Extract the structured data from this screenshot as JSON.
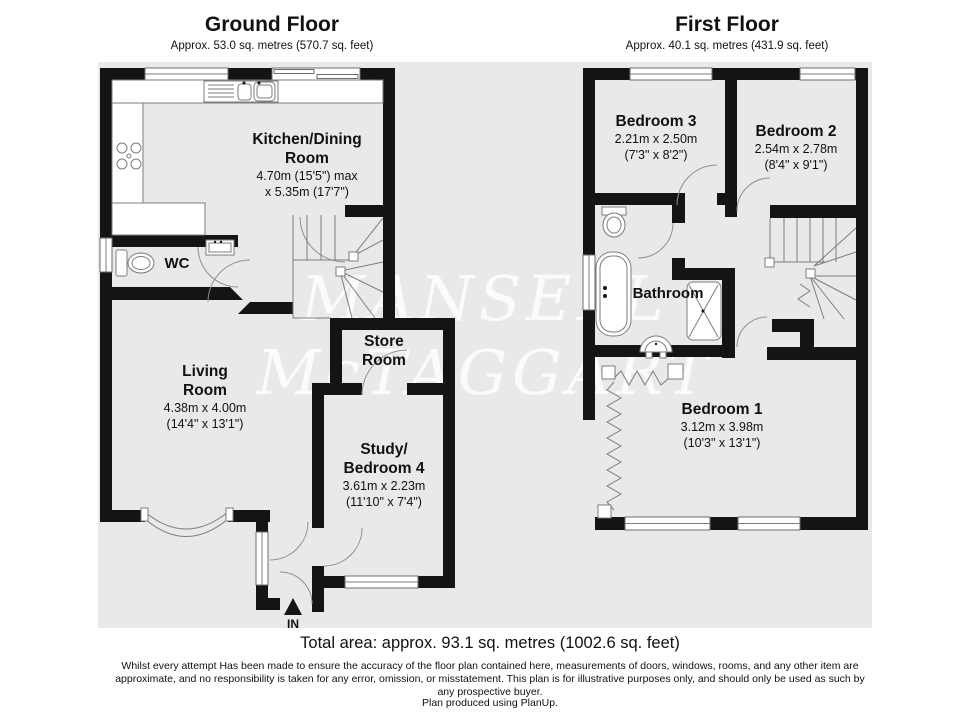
{
  "watermark": {
    "line1": "MANSELL",
    "line2": "McTAGGART"
  },
  "ground_floor": {
    "title": "Ground Floor",
    "area": "Approx. 53.0 sq. metres (570.7 sq. feet)",
    "rooms": {
      "kitchen": {
        "line1": "Kitchen/Dining",
        "line2": "Room",
        "dim1": "4.70m (15'5\") max",
        "dim2": "x 5.35m (17'7\")"
      },
      "wc": {
        "name": "WC"
      },
      "living": {
        "line1": "Living",
        "line2": "Room",
        "dim1": "4.38m x 4.00m",
        "dim2": "(14'4\" x 13'1\")"
      },
      "store": {
        "line1": "Store",
        "line2": "Room"
      },
      "study": {
        "line1": "Study/",
        "line2": "Bedroom 4",
        "dim1": "3.61m x 2.23m",
        "dim2": "(11'10\" x 7'4\")"
      }
    },
    "entrance_label": "IN"
  },
  "first_floor": {
    "title": "First Floor",
    "area": "Approx. 40.1 sq. metres (431.9 sq. feet)",
    "rooms": {
      "bedroom3": {
        "name": "Bedroom 3",
        "dim1": "2.21m x 2.50m",
        "dim2": "(7'3\" x 8'2\")"
      },
      "bedroom2": {
        "name": "Bedroom 2",
        "dim1": "2.54m x 2.78m",
        "dim2": "(8'4\" x 9'1\")"
      },
      "bathroom": {
        "name": "Bathroom"
      },
      "bedroom1": {
        "name": "Bedroom 1",
        "dim1": "3.12m x 3.98m",
        "dim2": "(10'3\" x 13'1\")"
      }
    }
  },
  "footer": {
    "total_area": "Total area: approx. 93.1 sq. metres (1002.6 sq. feet)",
    "disclaimer": "Whilst every attempt Has been made to ensure the accuracy of the floor plan contained here, measurements of doors, windows, rooms, and any other item are approximate, and no responsibility is taken for any error, omission, or misstatement. This plan is for illustrative purposes only, and should only be used as such by any prospective buyer.",
    "credit": "Plan produced using PlanUp."
  },
  "colors": {
    "wall": "#141414",
    "floor_fill": "#e9e9e9",
    "fixture_line": "#7d7d7d",
    "watermark": "#ffffff"
  }
}
